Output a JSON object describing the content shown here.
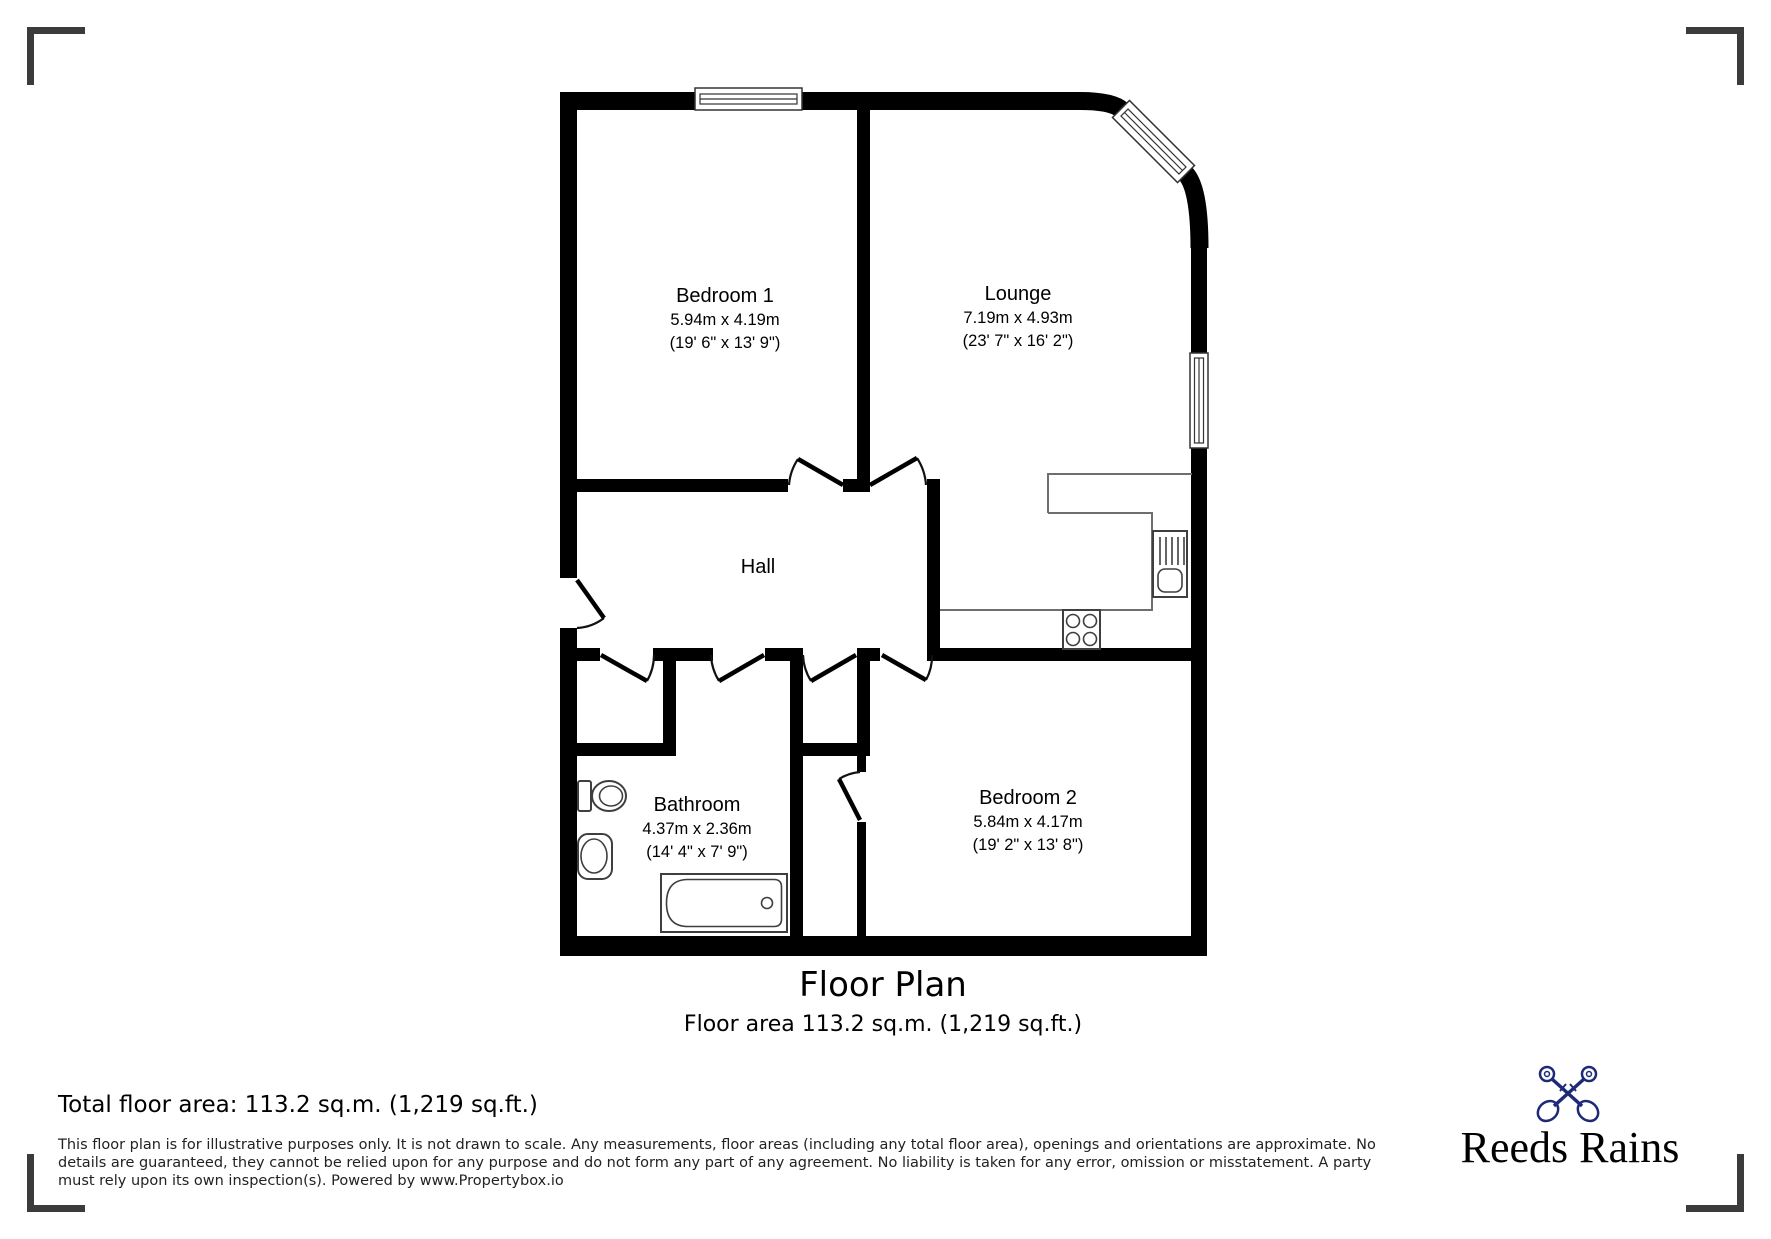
{
  "page": {
    "background": "#ffffff"
  },
  "floor_plan": {
    "wall_color": "#000000",
    "rooms": [
      {
        "name": "Bedroom 1",
        "size_metric": "5.94m x 4.19m",
        "size_imperial": "(19' 6\" x 13' 9\")"
      },
      {
        "name": "Lounge",
        "size_metric": "7.19m x 4.93m",
        "size_imperial": "(23' 7\" x 16' 2\")"
      },
      {
        "name": "Hall"
      },
      {
        "name": "Bathroom",
        "size_metric": "4.37m x 2.36m",
        "size_imperial": "(14' 4\" x 7' 9\")"
      },
      {
        "name": "Bedroom 2",
        "size_metric": "5.84m x 4.17m",
        "size_imperial": "(19' 2\" x 13' 8\")"
      }
    ],
    "fixtures": [
      "toilet",
      "basin",
      "bathtub",
      "kitchen-sink",
      "hob",
      "kitchen-counter"
    ],
    "title": "Floor Plan",
    "subtitle": "Floor area 113.2 sq.m. (1,219 sq.ft.)"
  },
  "footer": {
    "total_floor_area": "Total floor area: 113.2 sq.m. (1,219 sq.ft.)",
    "disclaimer": {
      "line1": "This floor plan is for illustrative purposes only. It is not drawn to scale. Any measurements, floor areas (including any total floor area), openings and orientations are approximate. No",
      "line2": "details are guaranteed, they cannot be relied upon for any purpose and do not form any part of any agreement. No liability is taken for any error, omission or misstatement. A party",
      "line3": "must rely upon its own inspection(s). Powered by www.Propertybox.io"
    },
    "brand": {
      "name": "Reeds Rains",
      "icon": "crossed-keys",
      "color": "#1e2a78"
    }
  }
}
